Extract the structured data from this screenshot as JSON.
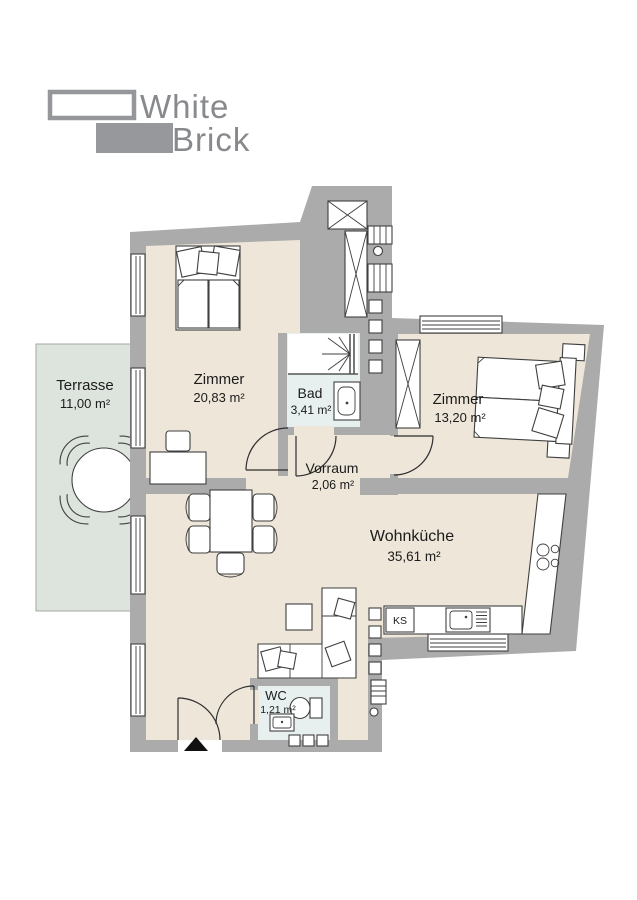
{
  "logo": {
    "line1": "White",
    "line2": "Brick"
  },
  "rooms": {
    "terrasse": {
      "name": "Terrasse",
      "area": "11,00 m²"
    },
    "zimmer1": {
      "name": "Zimmer",
      "area": "20,83 m²"
    },
    "bad": {
      "name": "Bad",
      "area": "3,41 m²"
    },
    "zimmer2": {
      "name": "Zimmer",
      "area": "13,20 m²"
    },
    "vorraum": {
      "name": "Vorraum",
      "area": "2,06 m²"
    },
    "wohnkueche": {
      "name": "Wohnküche",
      "area": "35,61 m²"
    },
    "wc": {
      "name": "WC",
      "area": "1,21 m²"
    }
  },
  "kitchen": {
    "fridge_label": "KS"
  },
  "colors": {
    "wall": "#ababab",
    "floor": "#ede6d9",
    "wet_floor": "#e7efef",
    "terrace_floor": "#dde3dd",
    "outline": "#3f3f3f",
    "logo_gray": "#909296",
    "entrance_marker": "#111111"
  }
}
